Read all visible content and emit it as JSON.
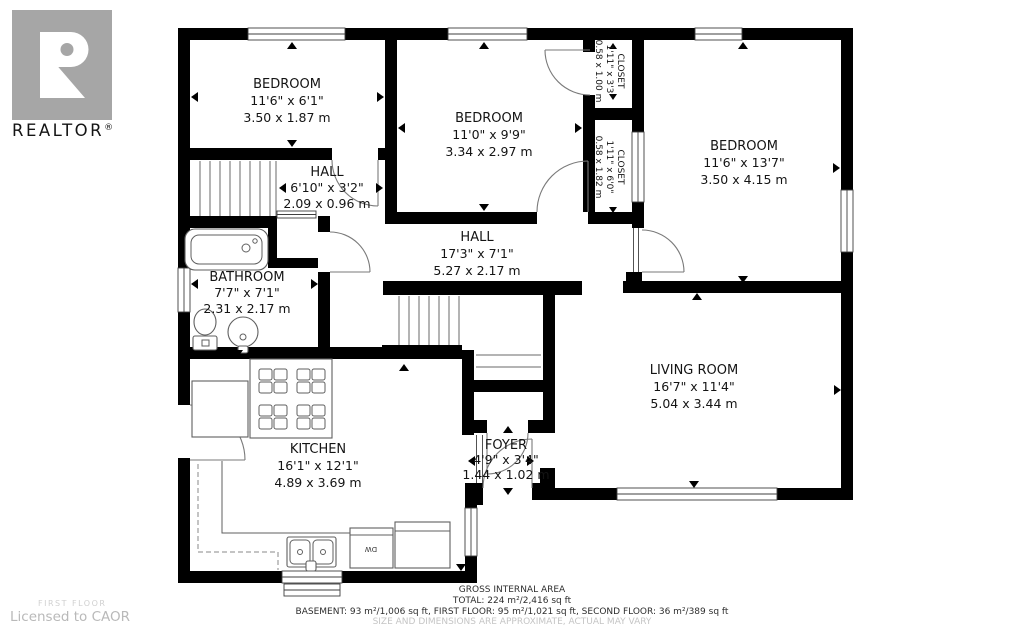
{
  "logo": {
    "letter": "R",
    "brand": "REALTOR",
    "registered": "®"
  },
  "watermark": {
    "floor": "FIRST FLOOR",
    "license": "Licensed to CAOR"
  },
  "rooms": {
    "bedroom1": {
      "name": "BEDROOM",
      "imperial": "11'6\" x 6'1\"",
      "metric": "3.50 x 1.87 m"
    },
    "bedroom2": {
      "name": "BEDROOM",
      "imperial": "11'0\" x 9'9\"",
      "metric": "3.34 x 2.97 m"
    },
    "bedroom3": {
      "name": "BEDROOM",
      "imperial": "11'6\" x 13'7\"",
      "metric": "3.50 x 4.15 m"
    },
    "hall_upper": {
      "name": "HALL",
      "imperial": "6'10\" x 3'2\"",
      "metric": "2.09 x 0.96 m"
    },
    "hall_main": {
      "name": "HALL",
      "imperial": "17'3\" x 7'1\"",
      "metric": "5.27 x 2.17 m"
    },
    "bathroom": {
      "name": "BATHROOM",
      "imperial": "7'7\" x 7'1\"",
      "metric": "2.31 x 2.17 m"
    },
    "closet_upper": {
      "name": "CLOSET",
      "imperial": "1'11\" x 3'3\"",
      "metric": "0.58 x 1.00 m"
    },
    "closet_lower": {
      "name": "CLOSET",
      "imperial": "1'11\" x 6'0\"",
      "metric": "0.58 x 1.82 m"
    },
    "living_room": {
      "name": "LIVING ROOM",
      "imperial": "16'7\" x 11'4\"",
      "metric": "5.04 x 3.44 m"
    },
    "kitchen": {
      "name": "KITCHEN",
      "imperial": "16'1\" x 12'1\"",
      "metric": "4.89 x 3.69 m"
    },
    "foyer": {
      "name": "FOYER",
      "imperial": "4'9\" x 3'4\"",
      "metric": "1.44 x 1.02 m"
    }
  },
  "labels": {
    "dishwasher": "DW"
  },
  "footer": {
    "title": "GROSS INTERNAL AREA",
    "total": "TOTAL: 224 m²/2,416 sq ft",
    "floors": "BASEMENT: 93 m²/1,006 sq ft, FIRST FLOOR: 95 m²/1,021 sq ft, SECOND FLOOR: 36 m²/389 sq ft",
    "disclaimer": "SIZE AND DIMENSIONS ARE APPROXIMATE, ACTUAL MAY VARY"
  },
  "colors": {
    "wall": "#000000",
    "logo_gray": "#a6a6a6",
    "text": "#141414",
    "muted": "#c5c5c5"
  }
}
